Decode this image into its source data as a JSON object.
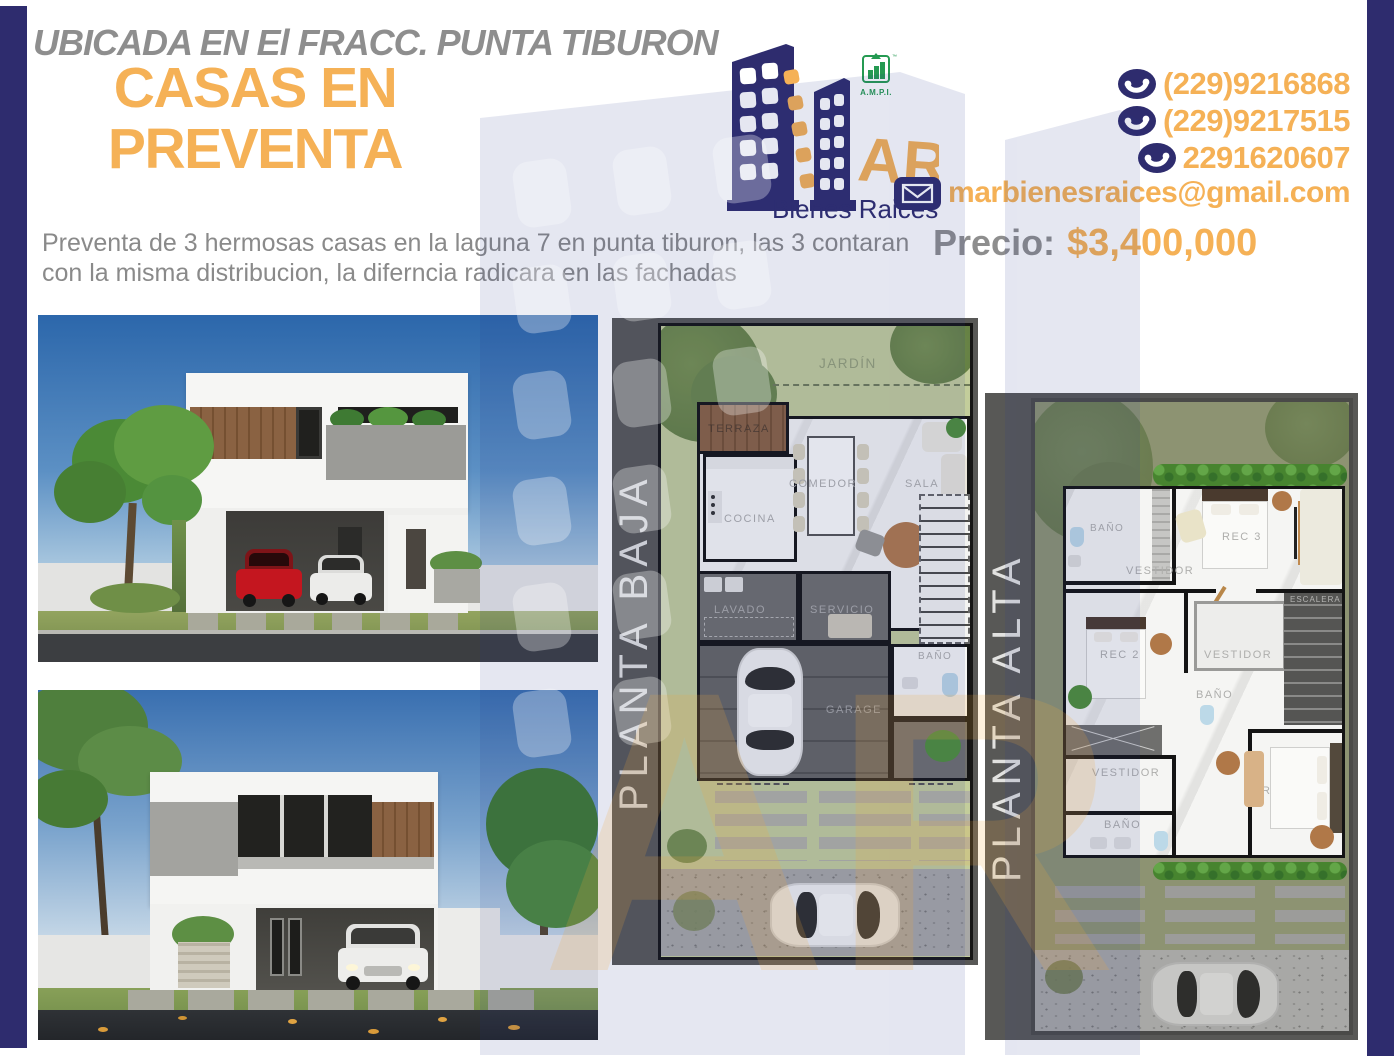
{
  "flyer": {
    "location_banner": "UBICADA EN El FRACC. PUNTA TIBURON",
    "title_line1": "CASAS EN",
    "title_line2": "PREVENTA",
    "description_line1": "Preventa de 3 hermosas casas en la laguna 7 en punta tiburon, las 3 contaran",
    "description_line2": "con la misma distribucion, la diferncia radicara en las fachadas"
  },
  "brand": {
    "logo_text": "AR",
    "tagline": "Bienes Raices",
    "ampi": "A.M.P.I."
  },
  "contact": {
    "phones": [
      "(229)9216868",
      "(229)9217515",
      "2291620607"
    ],
    "email": "marbienesraices@gmail.com"
  },
  "price": {
    "label": "Precio:",
    "amount": "$3,400,000"
  },
  "plans": {
    "baja": {
      "label": "PLANTA BAJA",
      "rooms": {
        "jardin": "JARDÍN",
        "terraza": "TERRAZA",
        "cocina": "COCINA",
        "comedor": "COMEDOR",
        "sala": "SALA",
        "lavado": "LAVADO",
        "servicio": "SERVICIO",
        "bano": "BAÑO",
        "escalera": "ESCALERA",
        "garage": "GARAGE"
      }
    },
    "alta": {
      "label": "PLANTA ALTA",
      "rooms": {
        "bano1": "BAÑO",
        "vestidor1": "VESTIDOR",
        "rec3": "REC 3",
        "tv": "TV",
        "rec2": "REC 2",
        "vestidor2": "VESTIDOR",
        "bano2": "BAÑO",
        "escalera": "ESCALERA",
        "vestidor3": "VESTIDOR",
        "bano3": "BAÑO",
        "rec_ppal": "REC PPAL"
      }
    }
  },
  "colors": {
    "navy": "#2e2c6e",
    "orange": "#f5b156",
    "text_gray": "#8e8e8e",
    "panel_gray": "#585856",
    "ampi_green": "#259a52",
    "lawn_green": "#c3cd9b",
    "olive_green": "#8d9372"
  }
}
